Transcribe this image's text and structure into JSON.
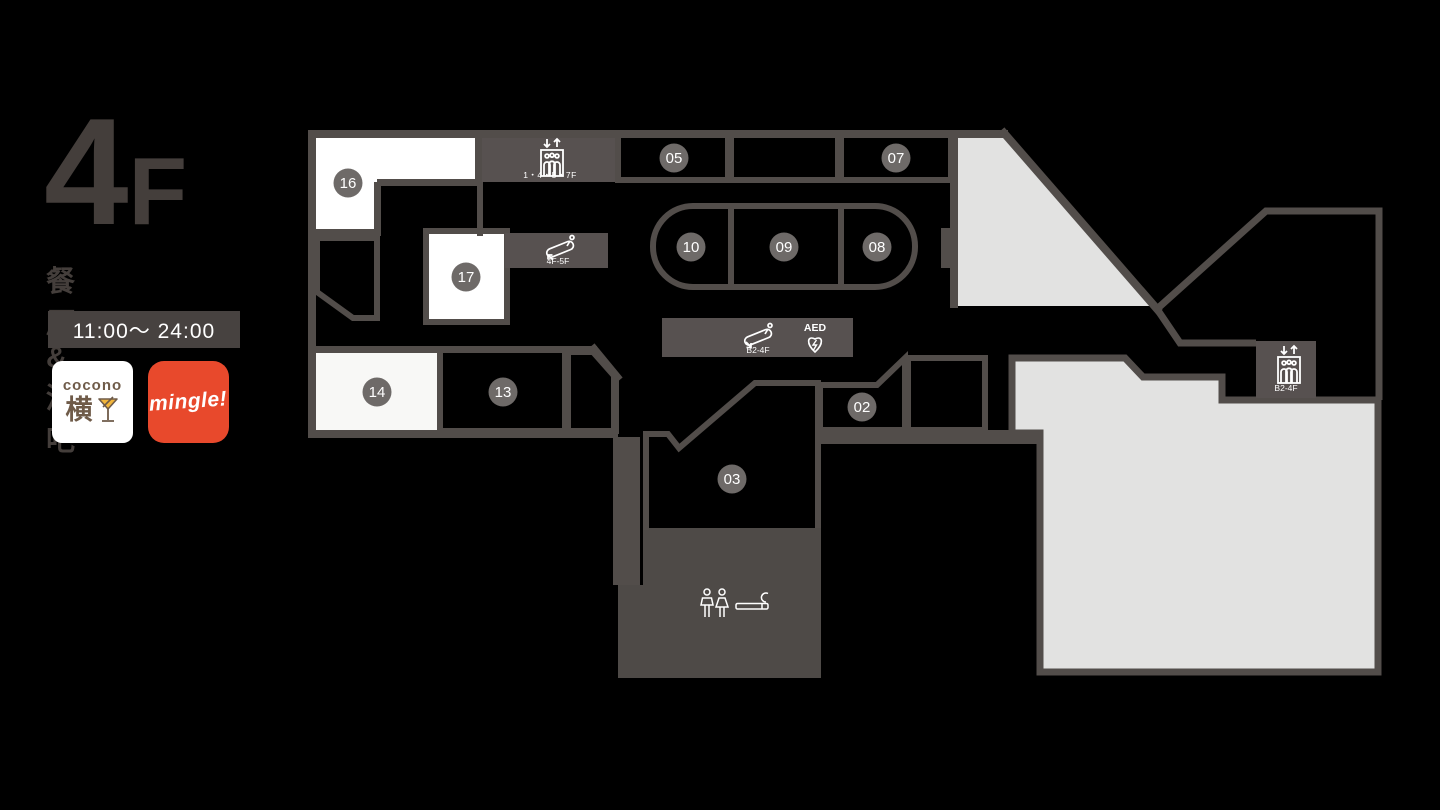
{
  "floor": {
    "number": "4",
    "suffix": "F",
    "category": "餐厅 & 酒吧",
    "hours": "11:00〜 24:00"
  },
  "logos": {
    "cocono": {
      "line1": "cocono",
      "line2": "横"
    },
    "mingle": {
      "text": "mingle!"
    }
  },
  "map": {
    "badges": [
      {
        "id": "05",
        "label": "05"
      },
      {
        "id": "07",
        "label": "07"
      },
      {
        "id": "10",
        "label": "10"
      },
      {
        "id": "09",
        "label": "09"
      },
      {
        "id": "08",
        "label": "08"
      },
      {
        "id": "16",
        "label": "16"
      },
      {
        "id": "17",
        "label": "17"
      },
      {
        "id": "14",
        "label": "14"
      },
      {
        "id": "13",
        "label": "13"
      },
      {
        "id": "02",
        "label": "02"
      },
      {
        "id": "03",
        "label": "03"
      }
    ],
    "facilities": {
      "elevator_main": {
        "label": "1・4・5・7F"
      },
      "escalator_upper": {
        "label": "4F-5F"
      },
      "escalator_lower": {
        "label": "B2-4F"
      },
      "aed": {
        "label": "AED"
      },
      "elevator_east": {
        "label": "B2-4F"
      }
    },
    "colors": {
      "wall": "#524d4a",
      "info_panel": "#575150",
      "facility_block": "#4e4a47",
      "badge": "#6e6a68",
      "open_area": "#e2e2e1",
      "room_white": "#ffffff",
      "background": "#000000",
      "accent_red": "#e8492c",
      "accent_brown": "#6f5b49"
    }
  }
}
